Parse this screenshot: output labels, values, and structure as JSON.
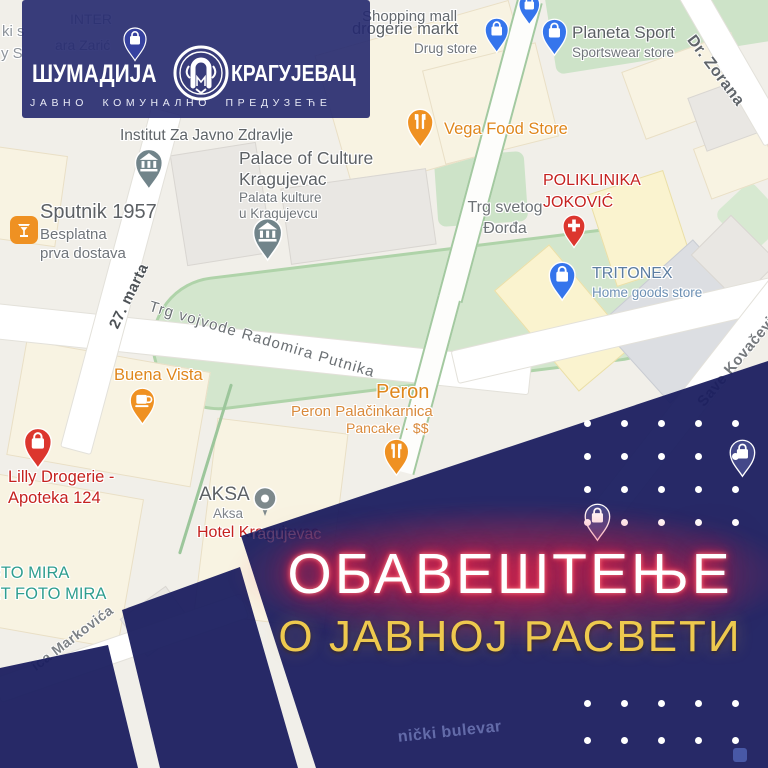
{
  "logo": {
    "name_left": "ШУМАДИЈА",
    "name_right": "КРАГУЈЕВАЦ",
    "tagline": "ЈАВНО КОМУНАЛНО ПРЕДУЗЕЋЕ",
    "emblem_icon": "shumadija-utility-emblem"
  },
  "announcement": {
    "title": "ОБАВЕШТЕЊЕ",
    "subtitle": "О ЈАВНОЈ РАСВЕТИ",
    "title_color": "#ffffff",
    "title_glow_color": "#ff2d4b",
    "subtitle_color": "#eec94e",
    "panel_color": "#232768"
  },
  "map": {
    "pois": [
      {
        "id": "shopping-mall",
        "title": "Shopping mall",
        "sub": [],
        "icon": "bag",
        "pin_color": "#3575ec",
        "title_color": "#64696e"
      },
      {
        "id": "drogerie-markt",
        "title": "drogerie markt",
        "sub": [
          "Drug store"
        ],
        "icon": "bag",
        "pin_color": "#3575ec",
        "title_color": "#5b6064",
        "sub_color": "#70757a"
      },
      {
        "id": "planeta-sport",
        "title": "Planeta Sport",
        "sub": [
          "Sportswear store"
        ],
        "icon": "bag",
        "pin_color": "#3575ec",
        "title_color": "#5b6064",
        "sub_color": "#70757a"
      },
      {
        "id": "vega-food-store",
        "title": "Vega Food Store",
        "sub": [],
        "icon": "food",
        "pin_color": "#ef9122",
        "title_color": "#df861b"
      },
      {
        "id": "poliklinika-jokovic",
        "title": "POLIKLINIKA|JOKOVIĆ",
        "sub": [],
        "icon": "hospital",
        "pin_color": "#dc362e",
        "title_color": "#c5221f"
      },
      {
        "id": "tritonex",
        "title": "TRITONEX",
        "sub": [
          "Home goods store"
        ],
        "icon": "bag",
        "pin_color": "#3575ec",
        "title_color": "#5c7da1",
        "sub_color": "#6d90b4"
      },
      {
        "id": "institut-za-javno-zdravlje",
        "title": "Institut Za Javno Zdravlje",
        "sub": [],
        "icon": "museum",
        "pin_color": "#71848a",
        "title_color": "#5f6468"
      },
      {
        "id": "palace-of-culture",
        "title": "Palace of Culture|Kragujevac",
        "sub": [
          "Palata kulture",
          "u Kragujevcu"
        ],
        "icon": "museum",
        "pin_color": "#71848a",
        "title_color": "#5d6165",
        "sub_color": "#70757a"
      },
      {
        "id": "trg-svetog-djordja",
        "title": "Trg svetog|Đorđa",
        "sub": [],
        "icon": "none",
        "title_color": "#6d7276"
      },
      {
        "id": "sputnik-1957",
        "title": "Sputnik 1957",
        "sub": [
          "Besplatna",
          "prva dostava"
        ],
        "icon": "drink-square",
        "pin_color": "#ef9122",
        "title_color": "#5c6064",
        "sub_color": "#6f747a"
      },
      {
        "id": "buena-vista",
        "title": "Buena Vista",
        "sub": [],
        "icon": "cafe",
        "pin_color": "#ef9122",
        "title_color": "#df861b"
      },
      {
        "id": "peron",
        "title": "Peron",
        "sub": [
          "Peron Palačinkarnica",
          "Pancake · $$"
        ],
        "icon": "food",
        "pin_color": "#ef9122",
        "title_color": "#df861b",
        "sub_color": "#d98a3c"
      },
      {
        "id": "lilly-drogerie",
        "title": "Lilly Drogerie -|Apoteka 124",
        "sub": [],
        "icon": "bag",
        "pin_color": "#dc362e",
        "title_color": "#c5221f"
      },
      {
        "id": "aksa",
        "title": "AKSA",
        "sub": [
          "Aksa"
        ],
        "icon": "circle",
        "pin_color": "#7d898c",
        "title_color": "#5d6165",
        "sub_color": "#7f848a"
      },
      {
        "id": "hotel-kragujevac",
        "title": "Hotel Kragujevac",
        "sub": [],
        "icon": "none",
        "title_color": "#c5221f"
      },
      {
        "id": "foto-mira",
        "title": "FOTO MIRA|ART FOTO MIRA",
        "sub": [],
        "icon": "none",
        "title_color": "#2f9e8f"
      }
    ],
    "streets": [
      {
        "id": "27-marta",
        "text": "27. marta"
      },
      {
        "id": "trg-vojvode",
        "text": "Trg vojvode Radomira Putnika"
      },
      {
        "id": "save-kovacevica",
        "text": "Save Kovačevića"
      },
      {
        "id": "dr-zorana",
        "text": "Dr. Zorana"
      },
      {
        "id": "markovica",
        "text": "ica Markovića"
      },
      {
        "id": "bulevar-ghost",
        "text": "nički bulevar"
      }
    ],
    "fragments": [
      {
        "id": "frag-ki-s",
        "text": "ki s"
      },
      {
        "id": "frag-inter",
        "text": "INTER"
      },
      {
        "id": "frag-y-s",
        "text": "y S"
      },
      {
        "id": "frag-zaric",
        "text": "ara Zarić"
      }
    ]
  },
  "decor": {
    "dot_color": "#ffffff",
    "dot_grid_top": {
      "x": 584,
      "y": 420,
      "cols": 5,
      "rows": 4,
      "dx": 37,
      "dy": 33
    },
    "dot_grid_bottom": {
      "x": 584,
      "y": 700,
      "cols": 5,
      "rows": 2,
      "dx": 37,
      "dy": 37
    }
  }
}
